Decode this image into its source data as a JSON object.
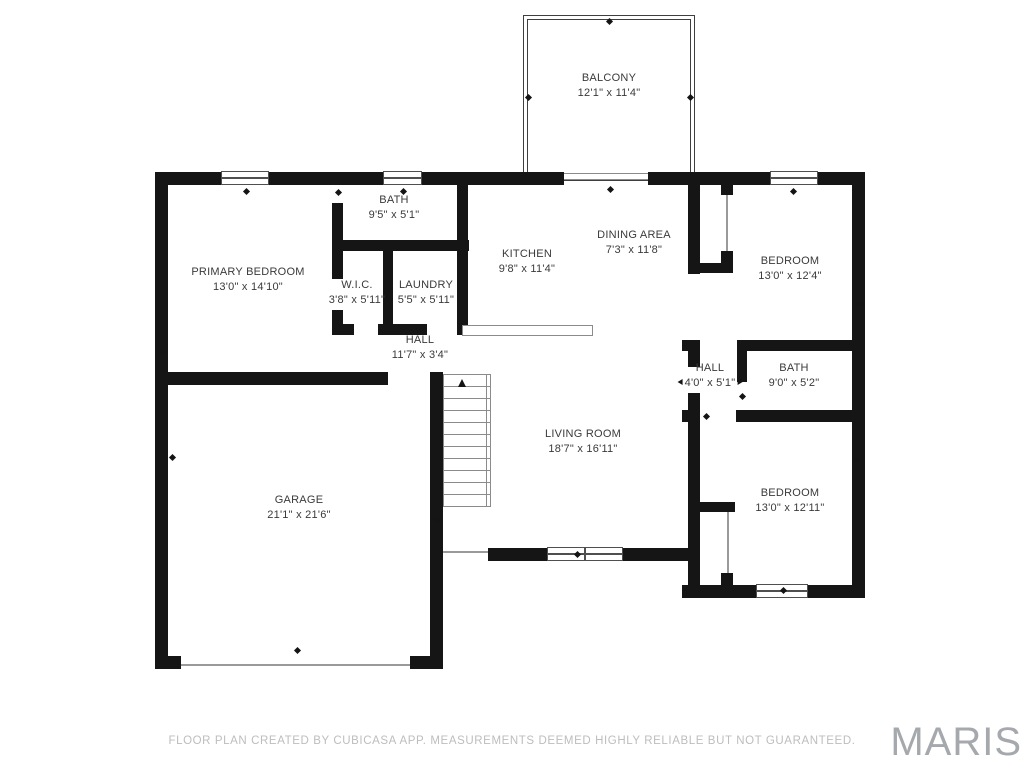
{
  "rooms": {
    "balcony": {
      "name": "BALCONY",
      "dims": "12'1\" x 11'4\""
    },
    "bath_top": {
      "name": "BATH",
      "dims": "9'5\" x 5'1\""
    },
    "primary_bedroom": {
      "name": "PRIMARY BEDROOM",
      "dims": "13'0\" x 14'10\""
    },
    "wic": {
      "name": "W.I.C.",
      "dims": "3'8\" x 5'11\""
    },
    "laundry": {
      "name": "LAUNDRY",
      "dims": "5'5\" x 5'11\""
    },
    "kitchen": {
      "name": "KITCHEN",
      "dims": "9'8\" x 11'4\""
    },
    "dining": {
      "name": "DINING AREA",
      "dims": "7'3\" x 11'8\""
    },
    "bedroom_tr": {
      "name": "BEDROOM",
      "dims": "13'0\" x 12'4\""
    },
    "hall_main": {
      "name": "HALL",
      "dims": "11'7\" x 3'4\""
    },
    "hall_right": {
      "name": "HALL",
      "dims": "4'0\" x 5'1\""
    },
    "bath_right": {
      "name": "BATH",
      "dims": "9'0\" x 5'2\""
    },
    "living": {
      "name": "LIVING ROOM",
      "dims": "18'7\" x 16'11\""
    },
    "garage": {
      "name": "GARAGE",
      "dims": "21'1\" x 21'6\""
    },
    "bedroom_br": {
      "name": "BEDROOM",
      "dims": "13'0\" x 12'11\""
    }
  },
  "footer": {
    "disclaimer": "FLOOR PLAN CREATED BY CUBICASA APP. MEASUREMENTS DEEMED HIGHLY RELIABLE BUT NOT GUARANTEED."
  },
  "branding": {
    "logo": "MARIS"
  },
  "colors": {
    "wall": "#151515",
    "label_text": "#3a3a3a",
    "footer_text": "#bdbdbd",
    "logo_text": "#a5a8ac",
    "background": "#ffffff"
  }
}
